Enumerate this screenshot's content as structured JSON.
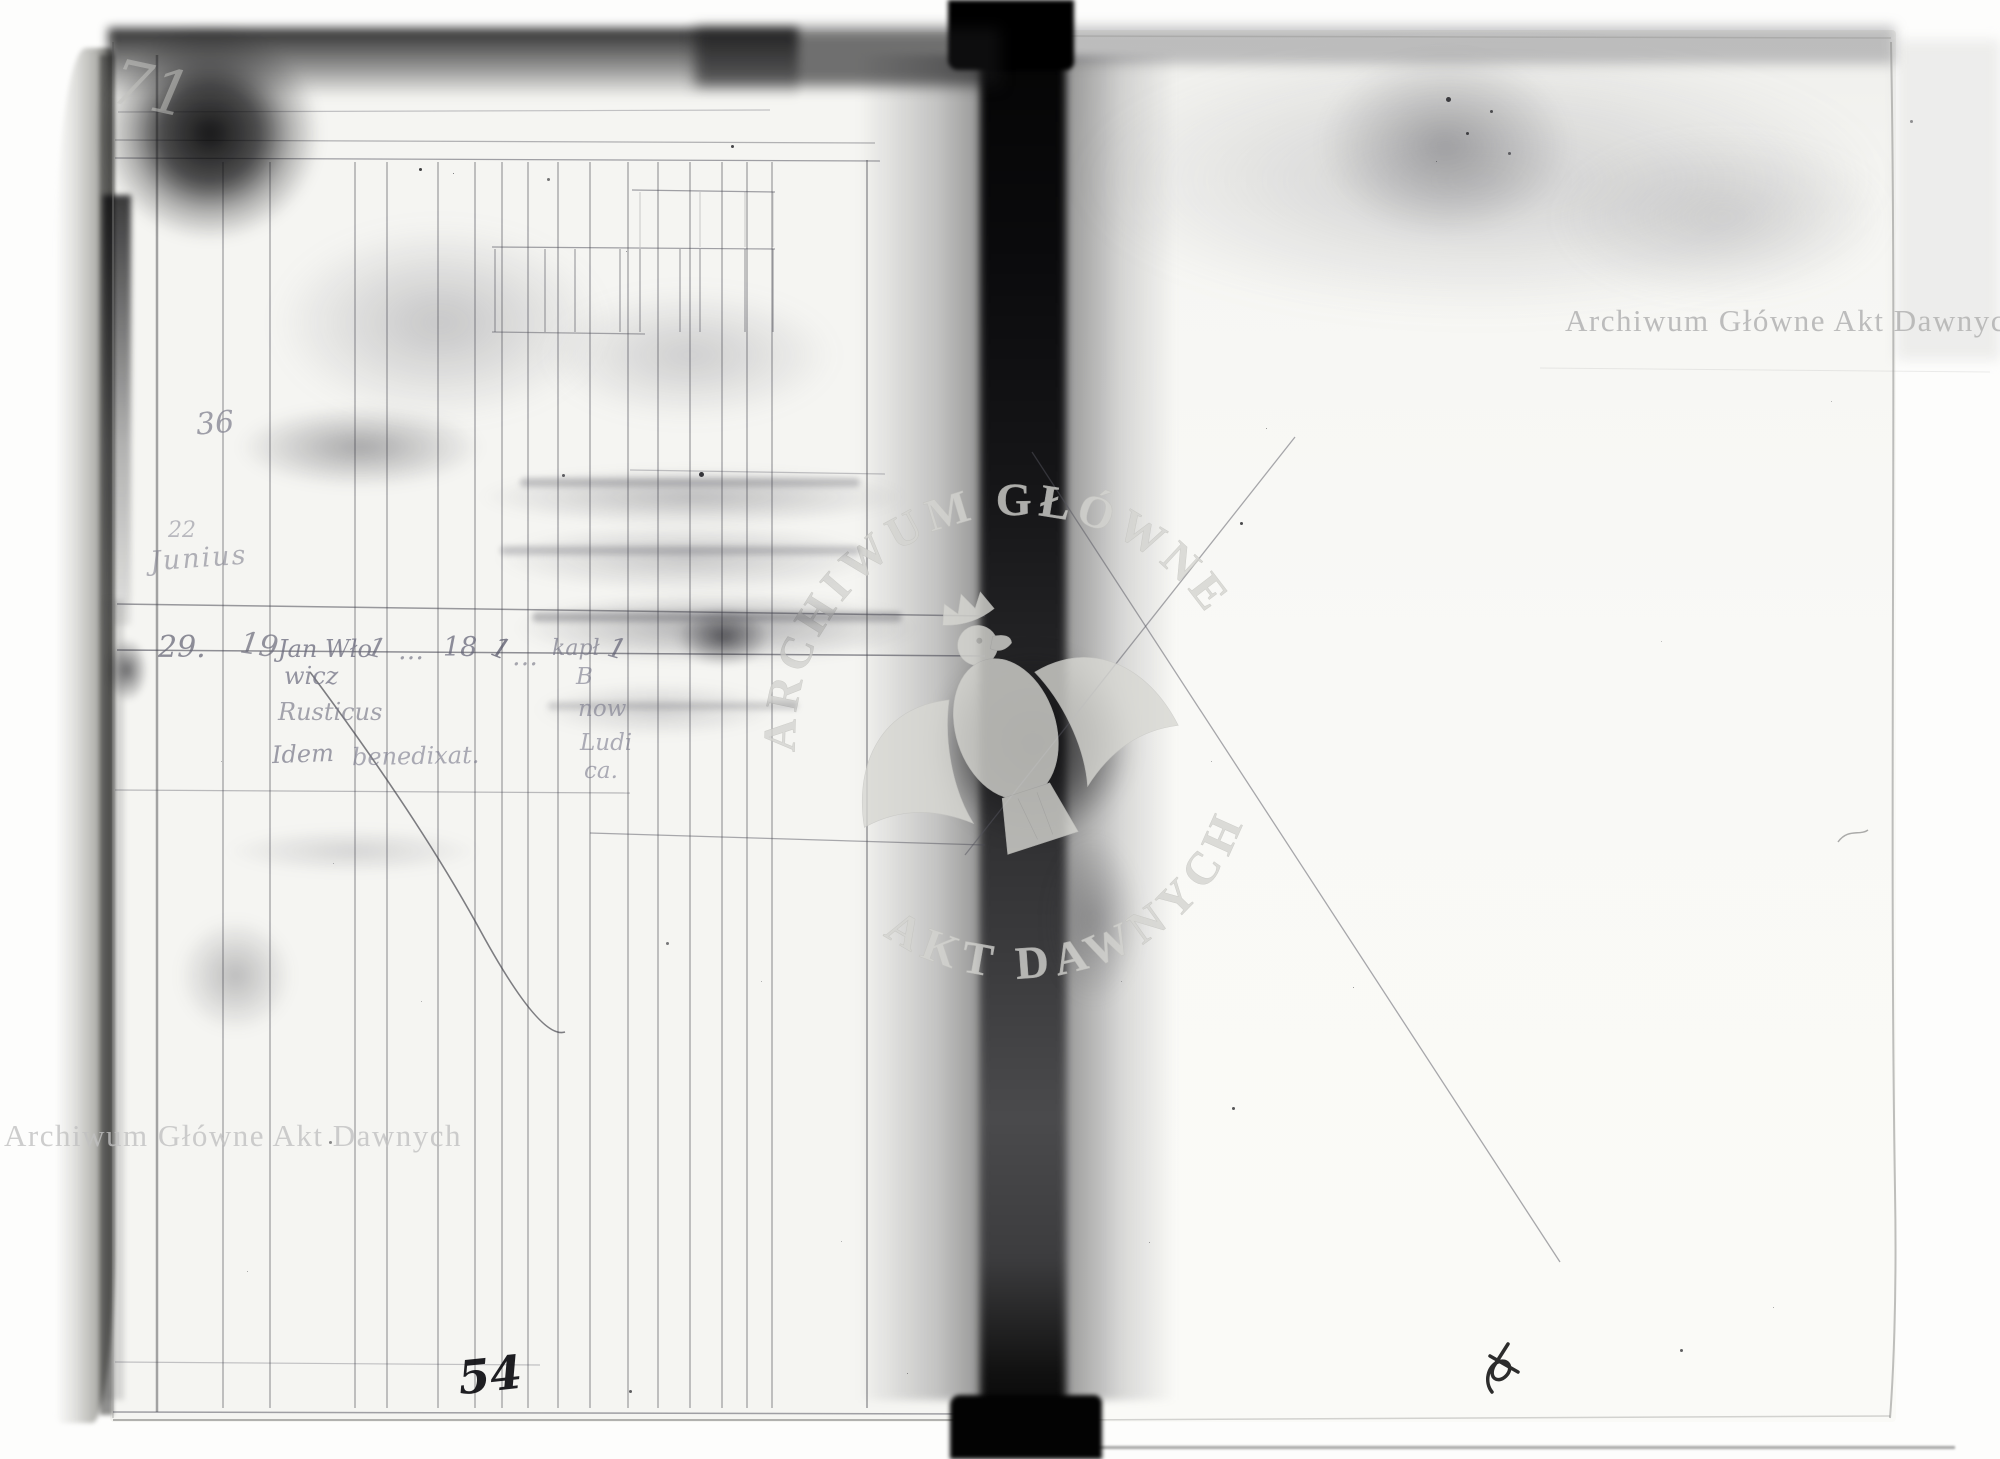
{
  "watermark": {
    "text": "Archiwum Główne Akt Dawnych",
    "seal_top_arc": "ARCHIWUM GŁÓWNE",
    "seal_bottom_arc": "AKT DAWNYCH",
    "color": "#bdbdbd"
  },
  "left_page": {
    "margin_top_number": "71",
    "margin_number_mid": "36",
    "margin_number_low": "22",
    "month_label": "Junius",
    "entry": {
      "day": "29.",
      "entry_no": "19",
      "name_line1": "Jan Wło",
      "name_line2": "wicz",
      "name_line3": "Rusticus",
      "tick_1": "1",
      "dots_1": "…",
      "value_18": "18",
      "tick_2": "1",
      "dots_2": "…",
      "cell_kapl": "kapł",
      "tick_3": "1",
      "cell_line_b": "B",
      "cell_line_now": "now",
      "cell_line_ludi": "Ludi",
      "cell_line_ca": "ca.",
      "note_word1": "Idem",
      "note_word2": "benedixat."
    },
    "page_number": "54"
  },
  "colors": {
    "paper": "#f6f6f3",
    "pencil_line": "#4a4a55",
    "ink": "#17171a",
    "gutter": "#070708",
    "watermark_gray": "#bdbdbd"
  }
}
